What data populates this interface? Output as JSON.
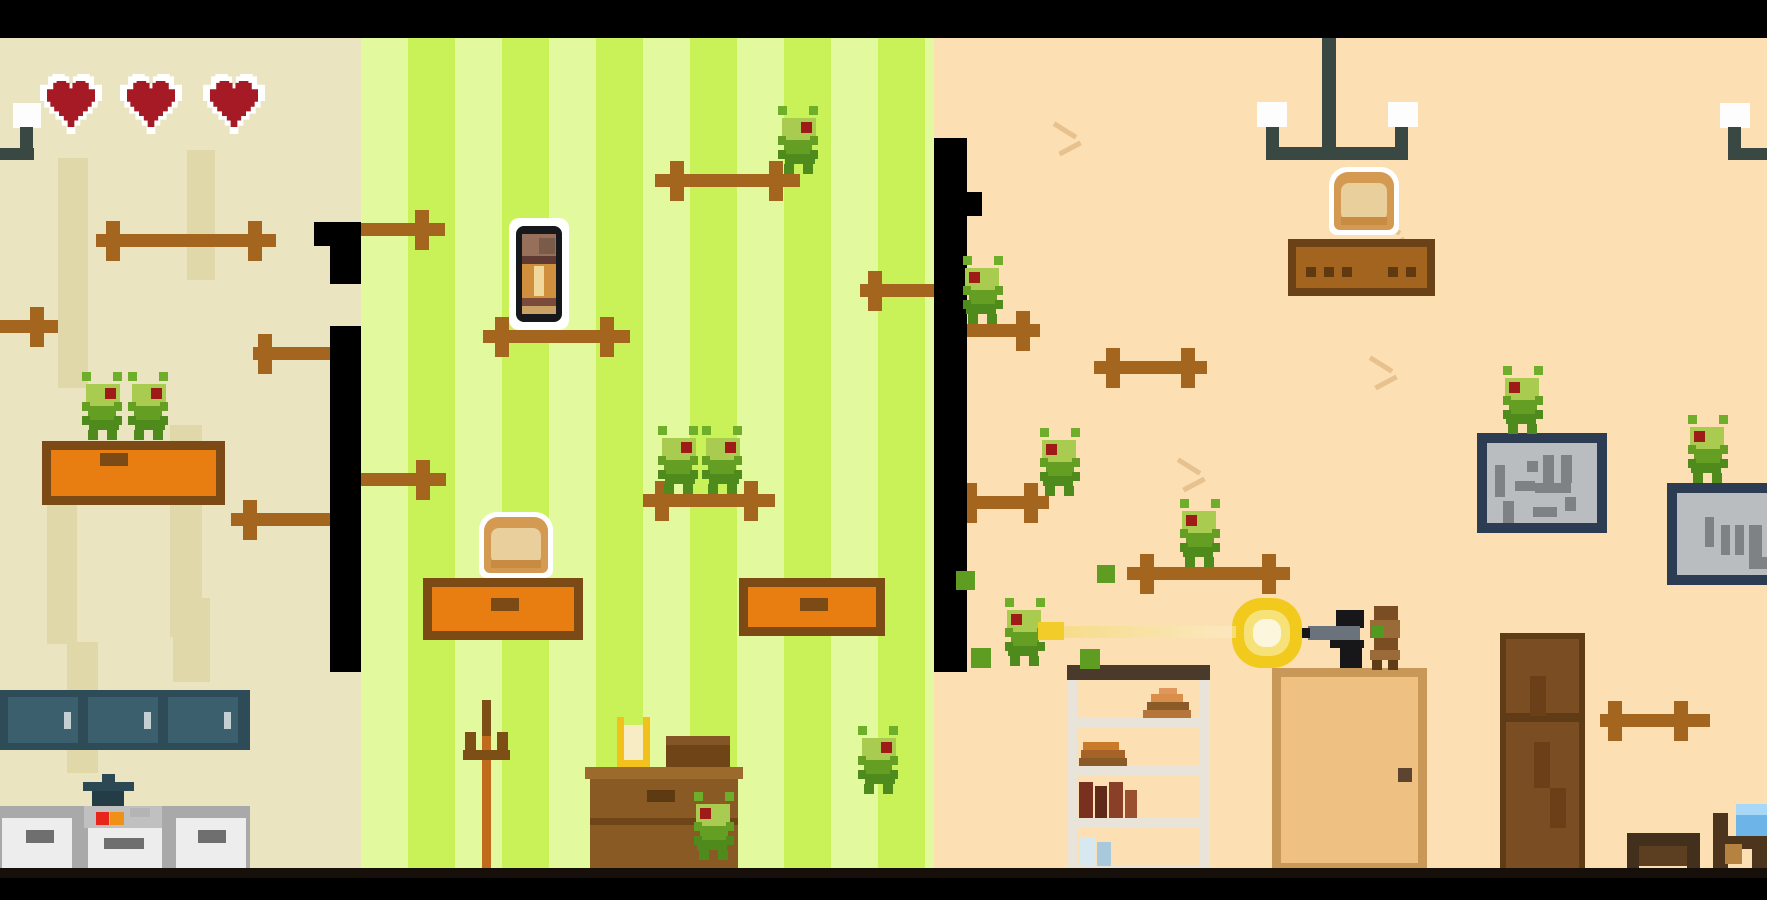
{
  "meta": {
    "scene": "pixel-house-bug-shooter",
    "rooms": 3
  },
  "hud": {
    "hearts": 3
  },
  "palette": {
    "letterbox": "#000000",
    "left_wall": "#eae4c0",
    "left_wall_stripe": "#e0d8a8",
    "mid_stripe_light": "#e3f99e",
    "mid_stripe_bright": "#c9f259",
    "right_wall": "#fcdfb2",
    "crack": "#e8c28e",
    "rod_brown": "#a4661e",
    "heart_red": "#a51a24",
    "bug_head": "#a9cb4f",
    "bug_body": "#649f24",
    "bug_eye": "#9e1b17",
    "furniture_orange": "#e87d12",
    "furniture_border": "#7c4b15",
    "cabinet_teal": "#2d4c57",
    "lamp_slate": "#3a4844",
    "door_tan": "#eec183",
    "wardrobe_brown": "#7a4e22",
    "board_navy": "#2c3c52",
    "board_gray": "#b9bdbf",
    "flash_yellow": "#f2ca1d",
    "tracer_yellow": "#f2cd2a",
    "bed_blue": "#6db4e8"
  },
  "entities": [
    {
      "type": "room",
      "name": "left-room-wall",
      "x": 0,
      "y": 38,
      "w": 361,
      "h": 832,
      "fill": "#eae4c0",
      "interactable": false
    },
    {
      "type": "room",
      "name": "middle-room-wall",
      "x": 361,
      "y": 38,
      "w": 573,
      "h": 832,
      "striped": true,
      "interactable": false
    },
    {
      "type": "room",
      "name": "right-room-wall",
      "x": 934,
      "y": 38,
      "w": 833,
      "h": 832,
      "fill": "#fcdfb2",
      "interactable": false
    },
    {
      "type": "stripe",
      "name": "wallpaper-stripe",
      "x": 58,
      "y": 158,
      "w": 30,
      "h": 230,
      "interactable": false
    },
    {
      "type": "stripe",
      "name": "wallpaper-stripe",
      "x": 187,
      "y": 150,
      "w": 28,
      "h": 130,
      "interactable": false
    },
    {
      "type": "stripe",
      "name": "wallpaper-stripe",
      "x": 47,
      "y": 479,
      "w": 30,
      "h": 165,
      "interactable": false
    },
    {
      "type": "stripe",
      "name": "wallpaper-stripe",
      "x": 170,
      "y": 425,
      "w": 32,
      "h": 212,
      "interactable": false
    },
    {
      "type": "stripe",
      "name": "wallpaper-stripe",
      "x": 67,
      "y": 642,
      "w": 31,
      "h": 131,
      "interactable": false
    },
    {
      "type": "stripe",
      "name": "wallpaper-stripe",
      "x": 173,
      "y": 598,
      "w": 37,
      "h": 84,
      "interactable": false
    },
    {
      "type": "crack",
      "name": "wall-crack",
      "x": 1050,
      "y": 122,
      "interactable": false
    },
    {
      "type": "crack",
      "name": "wall-crack",
      "x": 1374,
      "y": 218,
      "interactable": false
    },
    {
      "type": "crack",
      "name": "wall-crack",
      "x": 1366,
      "y": 356,
      "interactable": false
    },
    {
      "type": "crack",
      "name": "wall-crack",
      "x": 1174,
      "y": 458,
      "interactable": false
    },
    {
      "type": "lampleft",
      "name": "wall-lamp-icon",
      "x": 0,
      "y": 102,
      "w": 42,
      "h": 58,
      "interactable": false
    },
    {
      "type": "chandelier",
      "name": "ceiling-lamp-icon",
      "x": 1257,
      "y": 38,
      "w": 161,
      "h": 124,
      "interactable": false
    },
    {
      "type": "lampright",
      "name": "wall-lamp-icon",
      "x": 1720,
      "y": 102,
      "w": 47,
      "h": 58,
      "interactable": false
    },
    {
      "type": "heart",
      "name": "health-heart-icon",
      "x": 40,
      "y": 74,
      "w": 62,
      "h": 60,
      "interactable": false
    },
    {
      "type": "heart",
      "name": "health-heart-icon",
      "x": 120,
      "y": 74,
      "w": 62,
      "h": 60,
      "interactable": false
    },
    {
      "type": "heart",
      "name": "health-heart-icon",
      "x": 203,
      "y": 74,
      "w": 62,
      "h": 60,
      "interactable": false
    },
    {
      "type": "uppercabinet",
      "name": "kitchen-upper-cabinet",
      "x": 0,
      "y": 690,
      "w": 250,
      "h": 60,
      "interactable": false
    },
    {
      "type": "pot",
      "name": "cooking-pot",
      "x": 83,
      "y": 774,
      "w": 51,
      "h": 36,
      "interactable": false
    },
    {
      "type": "kitchen",
      "name": "kitchen-lower-counter",
      "x": 0,
      "y": 806,
      "w": 250,
      "h": 62,
      "interactable": false
    },
    {
      "type": "table",
      "name": "orange-drawer-platform",
      "x": 42,
      "y": 441,
      "w": 183,
      "h": 64,
      "hx": 58,
      "hy": 12,
      "interactable": false
    },
    {
      "type": "rod",
      "name": "wall-rod-platform",
      "x": 96,
      "y": 234,
      "w": 180,
      "crosses": [
        10,
        152
      ],
      "interactable": false
    },
    {
      "type": "rod",
      "name": "wall-rod-platform",
      "x": 0,
      "y": 320,
      "w": 58,
      "crosses": [
        30
      ],
      "interactable": false
    },
    {
      "type": "rod",
      "name": "wall-rod-platform",
      "x": 253,
      "y": 347,
      "w": 77,
      "crosses": [
        5
      ],
      "interactable": false
    },
    {
      "type": "rod",
      "name": "wall-rod-platform",
      "x": 231,
      "y": 513,
      "w": 99,
      "crosses": [
        12
      ],
      "interactable": false
    },
    {
      "type": "rod",
      "name": "wall-rod-platform",
      "x": 361,
      "y": 223,
      "w": 84,
      "crosses": [
        54
      ],
      "interactable": false
    },
    {
      "type": "rod",
      "name": "wall-rod-platform",
      "x": 483,
      "y": 330,
      "w": 147,
      "crosses": [
        12,
        117
      ],
      "interactable": false
    },
    {
      "type": "rod",
      "name": "wall-rod-platform",
      "x": 655,
      "y": 174,
      "w": 145,
      "crosses": [
        15,
        114
      ],
      "interactable": false
    },
    {
      "type": "rod",
      "name": "wall-rod-platform",
      "x": 643,
      "y": 494,
      "w": 132,
      "crosses": [
        12,
        101
      ],
      "interactable": false
    },
    {
      "type": "rod",
      "name": "wall-rod-platform",
      "x": 860,
      "y": 284,
      "w": 74,
      "crosses": [
        8
      ],
      "interactable": false
    },
    {
      "type": "rod",
      "name": "wall-rod-platform",
      "x": 361,
      "y": 473,
      "w": 85,
      "crosses": [
        55
      ],
      "interactable": false
    },
    {
      "type": "rod",
      "name": "wall-rod-platform",
      "x": 967,
      "y": 324,
      "w": 73,
      "crosses": [
        49
      ],
      "interactable": false
    },
    {
      "type": "rod",
      "name": "wall-rod-platform",
      "x": 951,
      "y": 496,
      "w": 98,
      "crosses": [
        12,
        73
      ],
      "interactable": false
    },
    {
      "type": "rod",
      "name": "wall-rod-platform",
      "x": 1127,
      "y": 567,
      "w": 163,
      "crosses": [
        13,
        135
      ],
      "interactable": false
    },
    {
      "type": "rod",
      "name": "wall-rod-platform",
      "x": 1094,
      "y": 361,
      "w": 113,
      "crosses": [
        12,
        87
      ],
      "interactable": false
    },
    {
      "type": "rod",
      "name": "wall-rod-platform",
      "x": 1600,
      "y": 714,
      "w": 110,
      "crosses": [
        8,
        74
      ],
      "interactable": false
    },
    {
      "type": "table",
      "name": "orange-table-platform",
      "x": 423,
      "y": 578,
      "w": 160,
      "h": 62,
      "hx": 68,
      "hy": 20,
      "interactable": false
    },
    {
      "type": "table",
      "name": "orange-table-platform",
      "x": 739,
      "y": 578,
      "w": 146,
      "h": 58,
      "hx": 61,
      "hy": 20,
      "interactable": false
    },
    {
      "type": "bread",
      "name": "bread-pickup",
      "x": 479,
      "y": 512,
      "w": 74,
      "h": 66,
      "interactable": true
    },
    {
      "type": "bullet",
      "name": "ammo-pickup",
      "x": 509,
      "y": 218,
      "w": 60,
      "h": 112,
      "interactable": true
    },
    {
      "type": "coatrack",
      "name": "coat-rack",
      "x": 458,
      "y": 700,
      "w": 52,
      "h": 176,
      "interactable": false
    },
    {
      "type": "dresser",
      "name": "dresser",
      "x": 585,
      "y": 736,
      "w": 158,
      "h": 140,
      "interactable": false
    },
    {
      "type": "candle",
      "name": "candle-holder",
      "x": 617,
      "y": 717,
      "w": 33,
      "h": 50,
      "interactable": false
    },
    {
      "type": "breadshelf",
      "name": "wall-shelf",
      "x": 1288,
      "y": 239,
      "w": 147,
      "h": 57,
      "interactable": false
    },
    {
      "type": "bread",
      "name": "bread-pickup",
      "x": 1329,
      "y": 167,
      "w": 70,
      "h": 68,
      "interactable": true
    },
    {
      "type": "bookshelf",
      "name": "bookshelf",
      "x": 1067,
      "y": 665,
      "w": 143,
      "h": 210,
      "interactable": false
    },
    {
      "type": "door",
      "name": "room-door",
      "x": 1272,
      "y": 668,
      "w": 155,
      "h": 204,
      "interactable": true
    },
    {
      "type": "wardrobe",
      "name": "wardrobe",
      "x": 1500,
      "y": 633,
      "w": 85,
      "h": 242,
      "interactable": false
    },
    {
      "type": "board",
      "name": "notice-board",
      "x": 1477,
      "y": 433,
      "w": 130,
      "h": 100,
      "variant": 1,
      "interactable": false
    },
    {
      "type": "board",
      "name": "notice-board",
      "x": 1667,
      "y": 483,
      "w": 120,
      "h": 102,
      "variant": 2,
      "interactable": false
    },
    {
      "type": "desk",
      "name": "small-desk",
      "x": 1627,
      "y": 833,
      "w": 73,
      "h": 44,
      "interactable": false
    },
    {
      "type": "bed",
      "name": "bed",
      "x": 1713,
      "y": 804,
      "w": 54,
      "h": 73,
      "interactable": false
    },
    {
      "type": "wall",
      "name": "partition-wall",
      "x": 330,
      "y": 222,
      "w": 31,
      "h": 62,
      "interactable": false
    },
    {
      "type": "wall",
      "name": "partition-wall",
      "x": 330,
      "y": 326,
      "w": 31,
      "h": 346,
      "interactable": false
    },
    {
      "type": "wall",
      "name": "partition-wall-notch",
      "x": 314,
      "y": 222,
      "w": 18,
      "h": 24,
      "interactable": false
    },
    {
      "type": "wall",
      "name": "partition-wall",
      "x": 934,
      "y": 138,
      "w": 33,
      "h": 534,
      "interactable": false
    },
    {
      "type": "wall",
      "name": "partition-wall-notch",
      "x": 967,
      "y": 192,
      "w": 15,
      "h": 24,
      "interactable": false
    },
    {
      "type": "bug",
      "name": "bug-enemy",
      "x": 82,
      "y": 372,
      "facing": "right",
      "interactable": true
    },
    {
      "type": "bug",
      "name": "bug-enemy",
      "x": 128,
      "y": 372,
      "facing": "right",
      "interactable": true
    },
    {
      "type": "bug",
      "name": "bug-enemy",
      "x": 778,
      "y": 106,
      "facing": "right",
      "interactable": true
    },
    {
      "type": "bug",
      "name": "bug-enemy",
      "x": 658,
      "y": 426,
      "facing": "right",
      "interactable": true
    },
    {
      "type": "bug",
      "name": "bug-enemy",
      "x": 702,
      "y": 426,
      "facing": "right",
      "interactable": true
    },
    {
      "type": "bug",
      "name": "bug-enemy",
      "x": 694,
      "y": 792,
      "facing": "left",
      "interactable": true
    },
    {
      "type": "bug",
      "name": "bug-enemy",
      "x": 858,
      "y": 726,
      "facing": "right",
      "interactable": true
    },
    {
      "type": "bug",
      "name": "bug-enemy",
      "x": 963,
      "y": 256,
      "facing": "left",
      "interactable": true
    },
    {
      "type": "bug",
      "name": "bug-enemy",
      "x": 1040,
      "y": 428,
      "facing": "left",
      "interactable": true
    },
    {
      "type": "bug",
      "name": "bug-enemy",
      "x": 1180,
      "y": 499,
      "facing": "left",
      "interactable": true
    },
    {
      "type": "bug",
      "name": "bug-enemy",
      "x": 1005,
      "y": 598,
      "facing": "left",
      "interactable": true
    },
    {
      "type": "bug",
      "name": "bug-enemy",
      "x": 1503,
      "y": 366,
      "facing": "left",
      "interactable": true
    },
    {
      "type": "bug",
      "name": "bug-enemy",
      "x": 1688,
      "y": 415,
      "facing": "left",
      "interactable": true
    },
    {
      "type": "character",
      "name": "player-character",
      "x": 1368,
      "y": 606,
      "w": 36,
      "h": 64,
      "interactable": true
    },
    {
      "type": "gun",
      "name": "pistol",
      "x": 1300,
      "y": 610,
      "w": 66,
      "h": 60,
      "interactable": false
    },
    {
      "type": "flash",
      "name": "muzzle-flash",
      "x": 1232,
      "y": 598,
      "w": 70,
      "h": 70,
      "interactable": false
    },
    {
      "type": "tracer",
      "name": "bullet-tracer",
      "x": 1038,
      "y": 620,
      "w": 200,
      "h": 22,
      "interactable": false
    },
    {
      "type": "particle",
      "name": "bug-debris",
      "x": 956,
      "y": 571,
      "s": 19,
      "interactable": false
    },
    {
      "type": "particle",
      "name": "bug-debris",
      "x": 1097,
      "y": 565,
      "s": 18,
      "interactable": false
    },
    {
      "type": "particle",
      "name": "bug-debris",
      "x": 1080,
      "y": 649,
      "s": 20,
      "interactable": false
    },
    {
      "type": "particle",
      "name": "bug-debris",
      "x": 971,
      "y": 648,
      "s": 20,
      "interactable": false
    },
    {
      "type": "bar",
      "name": "floor-line",
      "x": 0,
      "y": 868,
      "w": 1767,
      "h": 12,
      "fill": "#17100a",
      "interactable": false
    },
    {
      "type": "bar",
      "name": "letterbox-top",
      "x": 0,
      "y": 0,
      "w": 1767,
      "h": 38,
      "fill": "#000000",
      "interactable": false
    },
    {
      "type": "bar",
      "name": "letterbox-bottom",
      "x": 0,
      "y": 878,
      "w": 1767,
      "h": 22,
      "fill": "#000000",
      "interactable": false
    }
  ]
}
